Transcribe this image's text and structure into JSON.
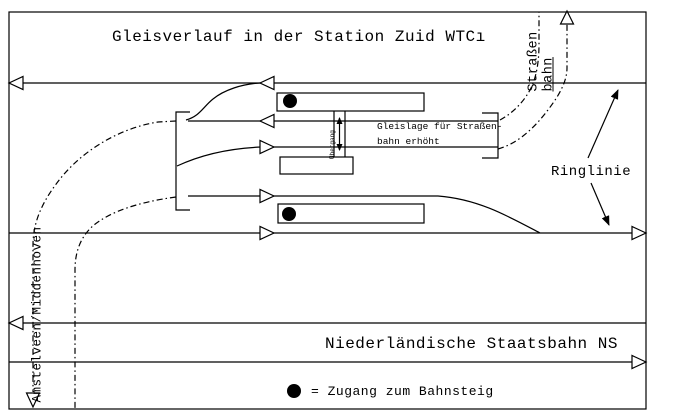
{
  "colors": {
    "ink": "#000000",
    "paper": "#ffffff"
  },
  "title": "Gleisverlauf in der Station Zuid WTCı",
  "labels": {
    "strassenbahn_word1": "Straßen",
    "strassenbahn_word2": "bahn",
    "ringlinie": "Ringlinie",
    "elevated_note_line1": "Gleislage für Straßen-",
    "elevated_note_line2": "bahn erhöht",
    "crossing": "Übergang",
    "left_route": "Amstelveen/Middenhoven",
    "ns_caption": "Niederländische Staatsbahn NS",
    "legend_text": "= Zugang zum Bahnsteig"
  },
  "legend": {
    "symbol_name": "platform-access-dot",
    "meaning": "Zugang zum Bahnsteig"
  }
}
